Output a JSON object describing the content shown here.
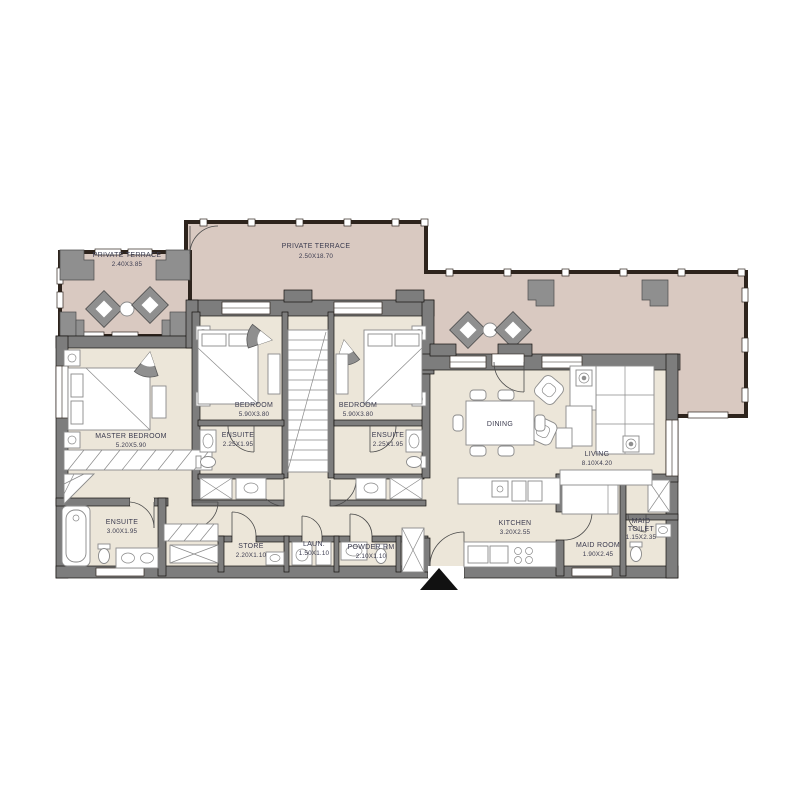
{
  "colors": {
    "terrace_floor": "#d9c9c1",
    "interior_floor": "#ece6d9",
    "wall_gray": "#7d7d7d",
    "glazing_dark": "#2e241d",
    "label_text": "#3b3b4f",
    "fixture_gray": "#8f8f8f",
    "entry_arrow": "#111111"
  },
  "rooms": {
    "terrace_left": {
      "name": "PRIVATE TERRACE",
      "dims": "2.40X3.85"
    },
    "terrace_top": {
      "name": "PRIVATE TERRACE",
      "dims": "2.50X18.70"
    },
    "master_bedroom": {
      "name": "MASTER BEDROOM",
      "dims": "5.20X5.90"
    },
    "bedroom_left": {
      "name": "BEDROOM",
      "dims": "5.90X3.80"
    },
    "bedroom_right": {
      "name": "BEDROOM",
      "dims": "5.90X3.80"
    },
    "ensuite_left": {
      "name": "ENSUITE",
      "dims": "2.25X1.95"
    },
    "ensuite_right": {
      "name": "ENSUITE",
      "dims": "2.25X1.95"
    },
    "ensuite_master": {
      "name": "ENSUITE",
      "dims": "3.00X1.95"
    },
    "store": {
      "name": "STORE",
      "dims": "2.20X1.10"
    },
    "laundry": {
      "name": "LAUN.",
      "dims": "1.50X1.10"
    },
    "powder_room": {
      "name": "POWDER RM",
      "dims": "2.10X1.10"
    },
    "dining": {
      "name": "DINING"
    },
    "living": {
      "name": "LIVING",
      "dims": "8.10X4.20"
    },
    "kitchen": {
      "name": "KITCHEN",
      "dims": "3.20X2.55"
    },
    "maid_room": {
      "name": "MAID ROOM",
      "dims": "1.90X2.45"
    },
    "maid_toilet": {
      "name": "MAID",
      "name2": "TOILET",
      "dims": "1.15X2.35"
    }
  }
}
